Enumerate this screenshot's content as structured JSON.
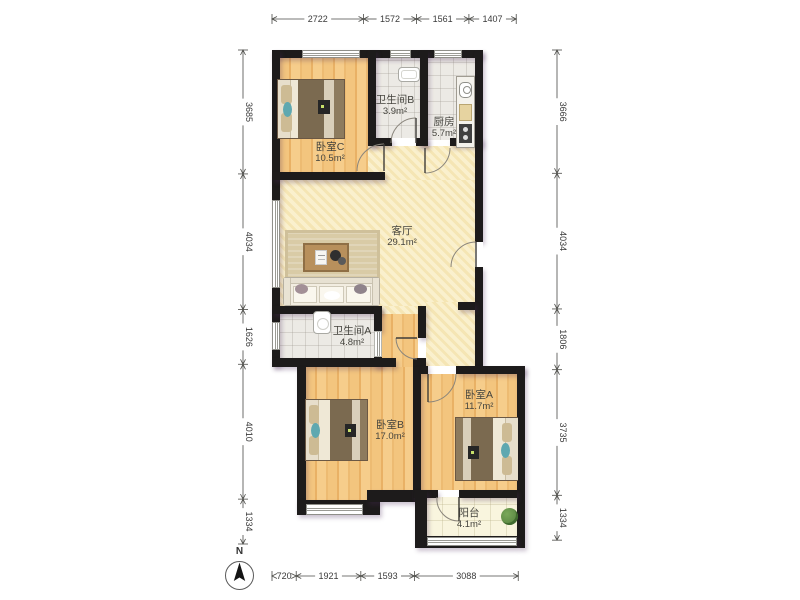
{
  "title": "三室两卫户型图",
  "compass": {
    "label": "N"
  },
  "rooms": [
    {
      "id": "bedroom-c",
      "name": "卧室C",
      "area": "10.5m²"
    },
    {
      "id": "bathroom-b",
      "name": "卫生间B",
      "area": "3.9m²"
    },
    {
      "id": "kitchen",
      "name": "厨房",
      "area": "5.7m²"
    },
    {
      "id": "living-room",
      "name": "客厅",
      "area": "29.1m²"
    },
    {
      "id": "bathroom-a",
      "name": "卫生间A",
      "area": "4.8m²"
    },
    {
      "id": "bedroom-b",
      "name": "卧室B",
      "area": "17.0m²"
    },
    {
      "id": "bedroom-a",
      "name": "卧室A",
      "area": "11.7m²"
    },
    {
      "id": "balcony",
      "name": "阳台",
      "area": "4.1m²"
    }
  ],
  "dimensions": {
    "top": {
      "values": [
        2722,
        1572,
        1561,
        1407
      ]
    },
    "left": {
      "values": [
        3685,
        4034,
        1626,
        4010,
        1334
      ]
    },
    "right": {
      "values": [
        3666,
        4034,
        1806,
        3735,
        1334
      ]
    },
    "bottom": {
      "values": [
        720,
        1921,
        1593,
        3088
      ]
    }
  },
  "colors": {
    "wall": "#1d1b1b",
    "wood_floor": "#f2c27a",
    "living_tile": "#f9edc5",
    "wet_tile": "#eceae5",
    "balcony_tile": "#f9f5de",
    "dimension_text": "#3a3a3a"
  }
}
